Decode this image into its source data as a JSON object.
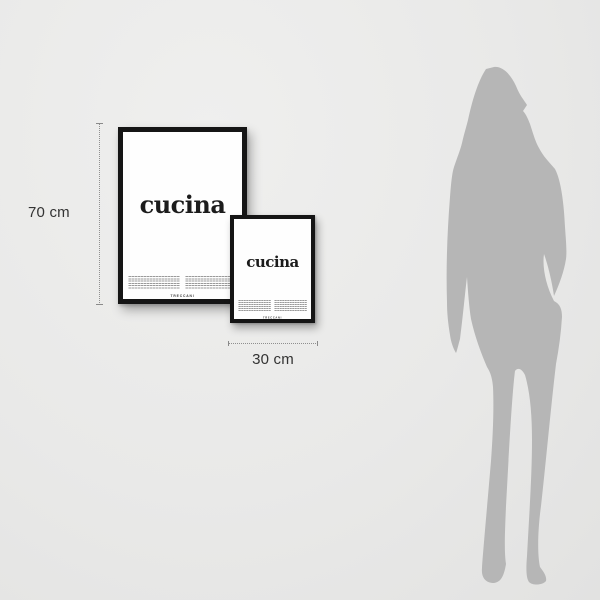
{
  "scene": {
    "description": "Poster size comparison against standing woman silhouette"
  },
  "dimension_annotations": {
    "height_label": "70 cm",
    "width_label": "30 cm"
  },
  "posters": {
    "large": {
      "title": "cucina",
      "brand": "TRECCANI"
    },
    "small": {
      "title": "cucina",
      "brand": "TRECCANI"
    }
  },
  "silhouette": {
    "type": "woman-standing"
  },
  "colors": {
    "background": "#e9e9e8",
    "frame": "#151515",
    "poster_white": "#fdfdfd",
    "title_text": "#1c1c1c",
    "silhouette_gray": "#b6b6b6",
    "dimension_line": "#8f8f8f",
    "dimension_text": "#333333"
  }
}
